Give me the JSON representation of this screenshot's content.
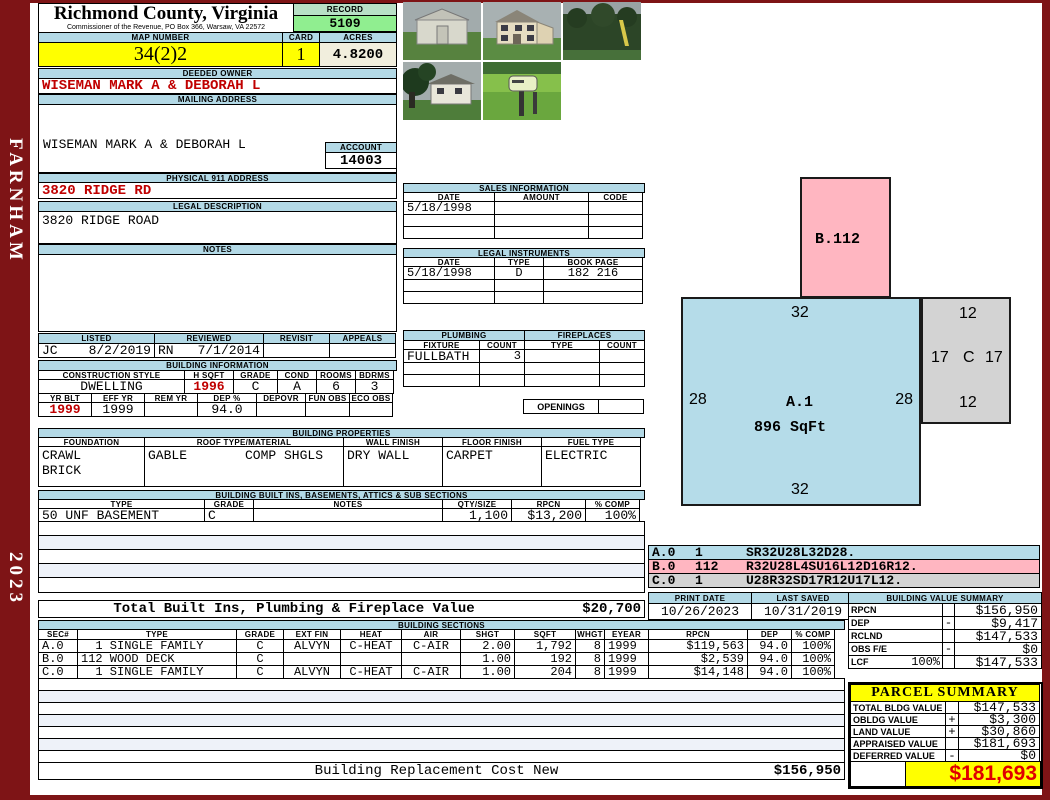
{
  "frame": {
    "district": "FARNHAM",
    "year": "2023"
  },
  "header": {
    "county": "Richmond County, Virginia",
    "commissioner": "Commissioner of the Revenue, PO Box 366, Warsaw, VA 22572",
    "record_label": "RECORD",
    "record": "5109",
    "map_label": "MAP NUMBER",
    "map": "34(2)2",
    "card_label": "CARD",
    "card": "1",
    "acres_label": "ACRES",
    "acres": "4.8200"
  },
  "owner": {
    "label": "DEEDED OWNER",
    "name": "WISEMAN MARK A & DEBORAH L"
  },
  "mailing": {
    "label": "MAILING ADDRESS",
    "line1": "WISEMAN MARK A & DEBORAH L",
    "line2": "3820 RIDGE ROAD",
    "line3": "",
    "line4": "FARNHAM, VA 22460-0000"
  },
  "account": {
    "label": "ACCOUNT",
    "value": "14003"
  },
  "physical": {
    "label": "PHYSICAL 911 ADDRESS",
    "value": "3820 RIDGE RD"
  },
  "legal": {
    "label": "LEGAL DESCRIPTION",
    "value": "3820 RIDGE ROAD"
  },
  "notes": {
    "label": "NOTES",
    "value": ""
  },
  "sales": {
    "title": "SALES INFORMATION",
    "h": [
      "DATE",
      "AMOUNT",
      "CODE"
    ],
    "rows": [
      [
        "5/18/1998",
        "",
        ""
      ],
      [
        "",
        "",
        ""
      ],
      [
        "",
        "",
        ""
      ]
    ]
  },
  "instruments": {
    "title": "LEGAL INSTRUMENTS",
    "h": [
      "DATE",
      "TYPE",
      "BOOK PAGE"
    ],
    "rows": [
      [
        "5/18/1998",
        "D",
        "182 216"
      ],
      [
        "",
        "",
        ""
      ],
      [
        "",
        "",
        ""
      ]
    ]
  },
  "plumbing": {
    "title": "PLUMBING",
    "h": [
      "FIXTURE",
      "COUNT"
    ],
    "rows": [
      [
        "FULLBATH",
        "3"
      ],
      [
        "",
        ""
      ],
      [
        "",
        ""
      ]
    ]
  },
  "fireplaces": {
    "title": "FIREPLACES",
    "h": [
      "TYPE",
      "COUNT"
    ],
    "rows": [
      [
        "",
        ""
      ],
      [
        "",
        ""
      ],
      [
        "",
        ""
      ]
    ],
    "openings": "OPENINGS"
  },
  "review": {
    "listed_label": "LISTED",
    "listed_by": "JC",
    "listed_date": "8/2/2019",
    "reviewed_label": "REVIEWED",
    "reviewed_by": "RN",
    "reviewed_date": "7/1/2014",
    "revisit_label": "REVISIT",
    "appeals_label": "APPEALS"
  },
  "building_info": {
    "title": "BUILDING INFORMATION",
    "r1h": [
      "CONSTRUCTION STYLE",
      "H SQFT",
      "GRADE",
      "COND",
      "ROOMS",
      "BDRMS"
    ],
    "r1v": [
      "DWELLING",
      "1996",
      "C",
      "A",
      "6",
      "3"
    ],
    "r2h": [
      "YR BLT",
      "EFF YR",
      "REM YR",
      "DEP %",
      "DEPOVR",
      "FUN OBS",
      "ECO OBS"
    ],
    "r2v": [
      "1999",
      "1999",
      "",
      "94.0",
      "",
      "",
      ""
    ]
  },
  "properties": {
    "title": "BUILDING PROPERTIES",
    "h": [
      "FOUNDATION",
      "ROOF TYPE/MATERIAL",
      "WALL FINISH",
      "FLOOR FINISH",
      "FUEL TYPE"
    ],
    "foundation1": "CRAWL",
    "foundation2": "BRICK",
    "roof1": "GABLE",
    "roof2": "COMP SHGLS",
    "wall": "DRY WALL",
    "floor": "CARPET",
    "fuel": "ELECTRIC"
  },
  "builtins": {
    "title": "BUILDING BUILT INS, BASEMENTS, ATTICS & SUB SECTIONS",
    "h": [
      "TYPE",
      "GRADE",
      "NOTES",
      "QTY/SIZE",
      "RPCN",
      "% COMP"
    ],
    "row": [
      "50 UNF BASEMENT",
      "C",
      "",
      "1,100",
      "$13,200",
      "100%"
    ],
    "total_label": "Total Built Ins, Plumbing & Fireplace Value",
    "total_value": "$20,700"
  },
  "sections": {
    "title": "BUILDING SECTIONS",
    "h": [
      "SEC#",
      "TYPE",
      "GRADE",
      "EXT FIN",
      "HEAT",
      "AIR",
      "SHGT",
      "SQFT",
      "WHGT",
      "EYEAR",
      "RPCN",
      "DEP",
      "% COMP"
    ],
    "rows": [
      [
        "A.0",
        "  1 SINGLE FAMILY",
        "C",
        "ALVYN",
        "C-HEAT",
        "C-AIR",
        "2.00",
        "1,792",
        "8",
        "1999",
        "$119,563",
        "94.0",
        "100%"
      ],
      [
        "B.0",
        "112 WOOD DECK",
        "C",
        "",
        "",
        "",
        "1.00",
        "192",
        "8",
        "1999",
        "$2,539",
        "94.0",
        "100%"
      ],
      [
        "C.0",
        "  1 SINGLE FAMILY",
        "C",
        "ALVYN",
        "C-HEAT",
        "C-AIR",
        "1.00",
        "204",
        "8",
        "1999",
        "$14,148",
        "94.0",
        "100%"
      ]
    ],
    "rcn_label": "Building Replacement Cost New",
    "rcn_value": "$156,950"
  },
  "sketch": {
    "a_label": "A.1",
    "a_sqft": "896 SqFt",
    "a_top": "32",
    "a_bottom": "32",
    "a_left": "28",
    "a_right": "28",
    "b_label": "B.112",
    "c_top": "12",
    "c_left": "17",
    "c_mid": "C",
    "c_right": "17",
    "c_bottom": "12",
    "legend": [
      {
        "sec": "A.0",
        "qty": "1",
        "path": "SR32U28L32D28."
      },
      {
        "sec": "B.0",
        "qty": "112",
        "path": "R32U28L4SU16L12D16R12."
      },
      {
        "sec": "C.0",
        "qty": "1",
        "path": "U28R32SD17R12U17L12."
      }
    ]
  },
  "dates": {
    "print_label": "PRINT DATE",
    "print": "10/26/2023",
    "saved_label": "LAST SAVED",
    "saved": "10/31/2019"
  },
  "value_summary": {
    "title": "BUILDING VALUE SUMMARY",
    "rows": [
      {
        "label": "RPCN",
        "pct": "",
        "sign": "",
        "value": "$156,950"
      },
      {
        "label": "DEP",
        "pct": "",
        "sign": "-",
        "value": "$9,417"
      },
      {
        "label": "RCLND",
        "pct": "",
        "sign": "",
        "value": "$147,533"
      },
      {
        "label": "OBS F/E",
        "pct": "",
        "sign": "-",
        "value": "$0"
      },
      {
        "label": "LCF",
        "pct": "100%",
        "sign": "",
        "value": "$147,533"
      }
    ]
  },
  "parcel": {
    "title": "PARCEL SUMMARY",
    "rows": [
      {
        "label": "TOTAL BLDG VALUE",
        "sign": "",
        "value": "$147,533"
      },
      {
        "label": "OBLDG VALUE",
        "sign": "+",
        "value": "$3,300"
      },
      {
        "label": "LAND VALUE",
        "sign": "+",
        "value": "$30,860"
      },
      {
        "label": "APPRAISED VALUE",
        "sign": "",
        "value": "$181,693"
      },
      {
        "label": "DEFERRED VALUE",
        "sign": "-",
        "value": "$0"
      }
    ],
    "taxable_label1": "TAXABLE",
    "taxable_label2": "VALUE",
    "taxable": "$181,693"
  },
  "colors": {
    "maroon": "#7e1416",
    "header_blue": "#b3d9e6",
    "green": "#90ee90",
    "yellow": "#ffff00",
    "cream": "#f1eedd",
    "sketch_blue": "#b5dce9",
    "sketch_pink": "#ffb6c1",
    "sketch_gray": "#d3d3d3",
    "red_text": "#c00000"
  }
}
